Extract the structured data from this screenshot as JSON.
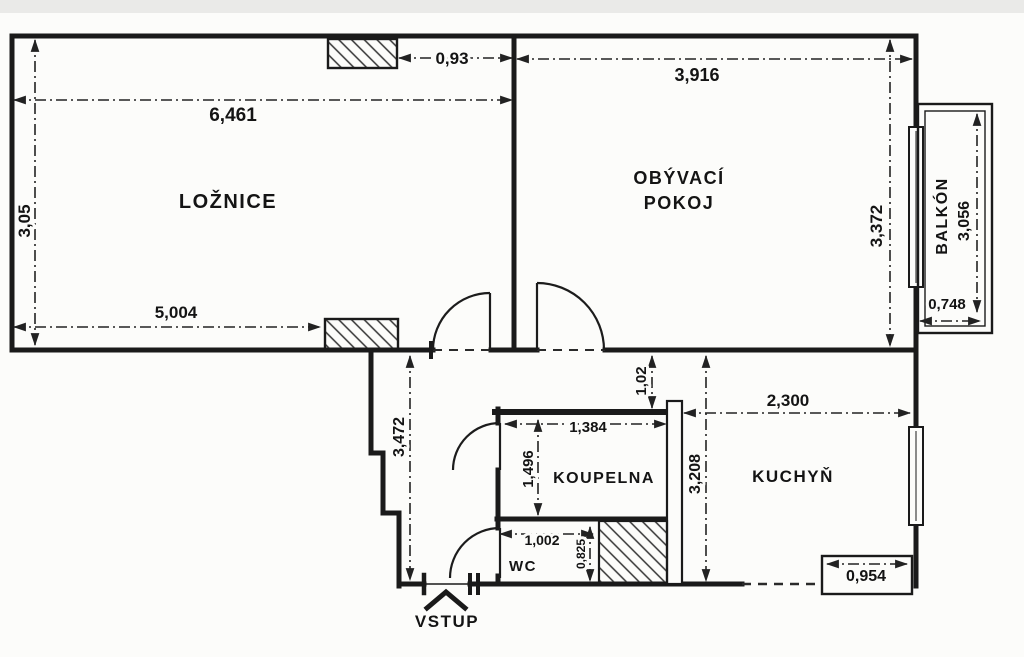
{
  "plan_title": "apartment floor plan",
  "rooms": {
    "bedroom": {
      "label": "LOŽNICE"
    },
    "living": {
      "line1": "OBÝVACÍ",
      "line2": "POKOJ"
    },
    "balcony": {
      "label": "BALKÓN"
    },
    "bathroom": {
      "label": "KOUPELNA"
    },
    "kitchen": {
      "label": "KUCHYŇ"
    },
    "wc": {
      "label": "WC"
    },
    "entrance": {
      "label": "VSTUP"
    }
  },
  "dims": {
    "bedroom_width": "6,461",
    "bedroom_depth": "3,05",
    "bedroom_wall": "5,004",
    "flue_offset": "0,93",
    "living_width": "3,916",
    "living_depth": "3,372",
    "balcony_length": "3,056",
    "balcony_depth": "0,748",
    "hall_length": "3,472",
    "corridor_width": "1,02",
    "bathroom_width": "1,384",
    "bathroom_depth": "1,496",
    "kitchen_width": "2,300",
    "kitchen_depth": "3,208",
    "wc_width": "1,002",
    "wc_depth": "0,825",
    "kitchen_recess": "0,954"
  },
  "colors": {
    "ink": "#1a1a1a",
    "paper": "#fcfcfa"
  }
}
